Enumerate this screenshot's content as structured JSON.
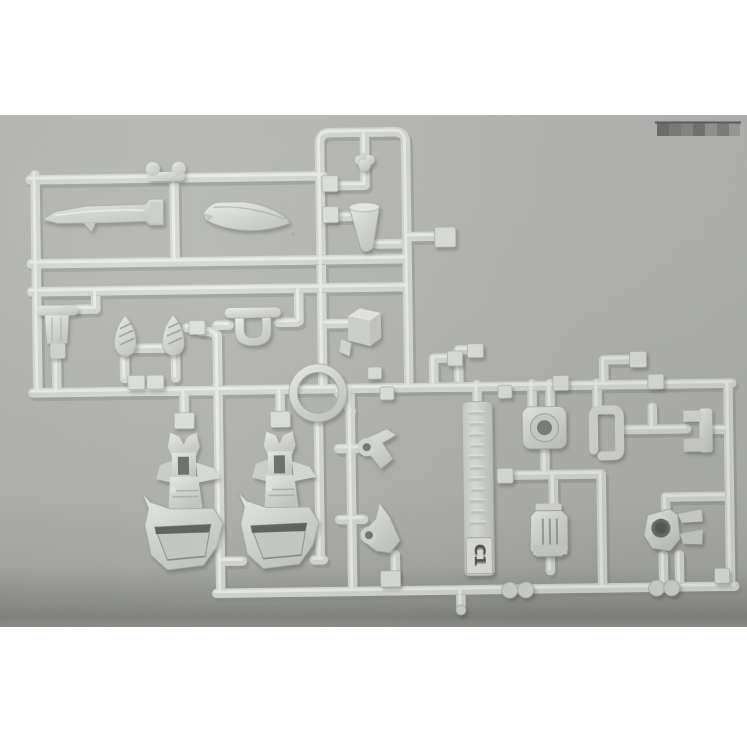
{
  "scene": {
    "description": "Product photograph of a light-gray injection-molded plastic model kit sprue (parts runner) lying on a gray board, white page background above and below the photo",
    "photo_area": {
      "top_px": 115,
      "height_px": 512,
      "width_px": 747
    },
    "colors": {
      "page_background": "#ffffff",
      "photo_background": "#b3b5b2",
      "photo_bottom_shadow": "#83857f",
      "plastic_base": "#d6d9d4",
      "plastic_highlight": "#f3f5f0",
      "plastic_shadow": "#8f938c",
      "dark_slot": "#5e615b",
      "engraved_text": "#50534d"
    }
  },
  "sprue": {
    "tag": {
      "label": "C1",
      "orientation": "vertical tag with embossed illegible text, code box at bottom"
    },
    "visible_parts": [
      "elongated nacelle piece",
      "curved cowling piece",
      "funnel thruster piece",
      "torso piece",
      "two vented fin pieces",
      "u-shaped handle piece",
      "cube box piece",
      "large ring piece",
      "two leg armor pieces with dark visor slots",
      "two claw pieces with eyelet holes",
      "round flanged socket piece",
      "open square bracket piece",
      "c-bracket piece",
      "ribbed gearbox piece",
      "joint piece with round hole"
    ]
  },
  "watermark": {
    "description": "pixelated gray censor blocks, top right of photo",
    "block_colors": [
      "#6e6e6e",
      "#7e7e7e",
      "#8a8a8a",
      "#757575",
      "#969696",
      "#808080",
      "#9e9e9e"
    ]
  }
}
